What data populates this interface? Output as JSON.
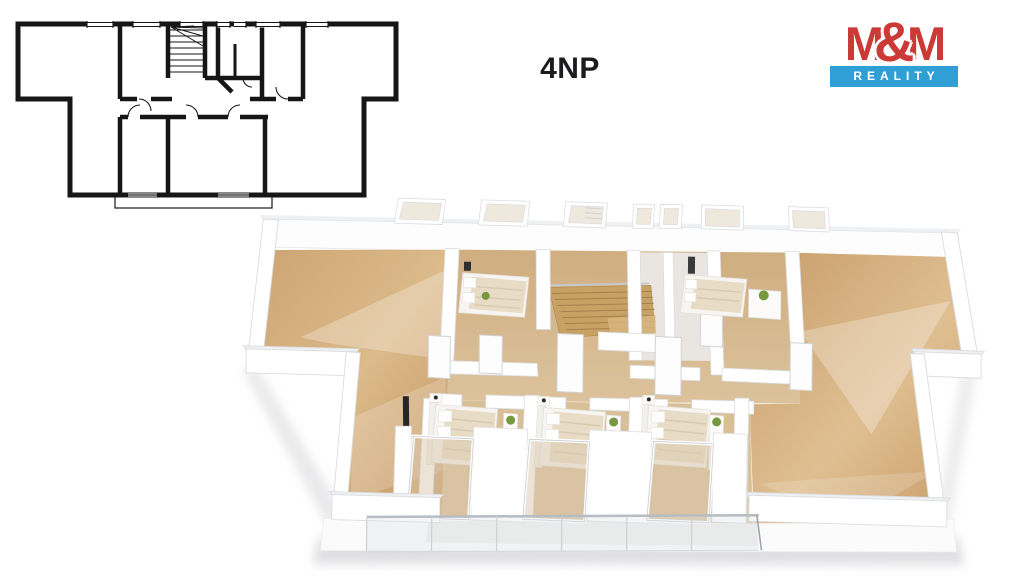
{
  "page": {
    "background": "#ffffff"
  },
  "floor_plan": {
    "floor_label": "4NP"
  },
  "logo": {
    "m_left": "M",
    "ampersand": "&",
    "m_right": "M",
    "tagline": "REALITY",
    "brand_color": "#cb3a37",
    "tagline_bg": "#2f9fd6",
    "tagline_color": "#ffffff"
  },
  "plan_2d": {
    "wall_color": "#161616"
  },
  "plan_3d": {
    "colors": {
      "wood": "#c89c69",
      "wood_light": "#e0c49a",
      "bedroom_wood": "#d5b98e",
      "wall": "#ffffff",
      "window": "#efe8dd",
      "bed": "#e8dcc6",
      "stairs": "#c8a165",
      "plant": "#76983f",
      "glass": "#d9c8ae"
    },
    "depicted": {
      "bedrooms_bottom": 3,
      "bedrooms_top": 2,
      "balcony_with_glass_railing": 1
    }
  }
}
